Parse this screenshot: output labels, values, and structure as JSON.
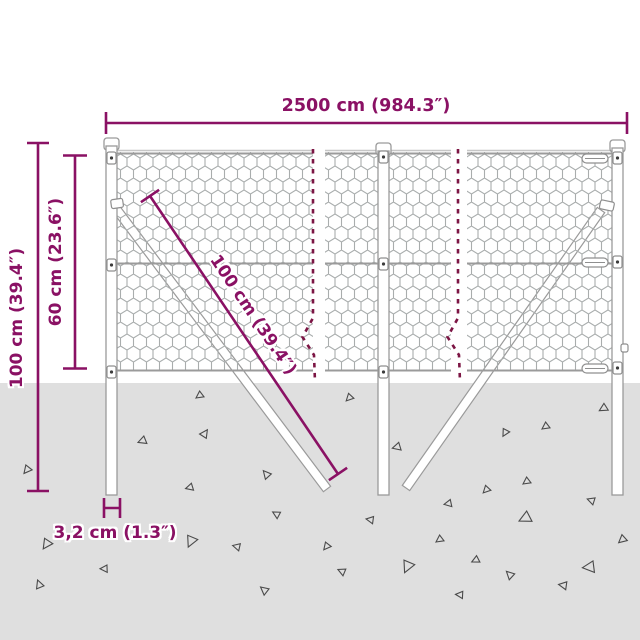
{
  "title": "Wire mesh fence dimension diagram",
  "colors": {
    "dimension_accent": "#8a1164",
    "break_line": "#7c1544",
    "ground": "#dfdfdf",
    "mesh_wire": "#a9adad",
    "structure_outline": "#9a9a9a"
  },
  "dimensions": {
    "width_label": "2500 cm (984.3″)",
    "total_height_label": "100 cm (39.4″)",
    "mesh_height_label": "60 cm (23.6″)",
    "strut_length_label": "100 cm (39.4″)",
    "post_width_label": "3,2 cm (1.3″)"
  }
}
